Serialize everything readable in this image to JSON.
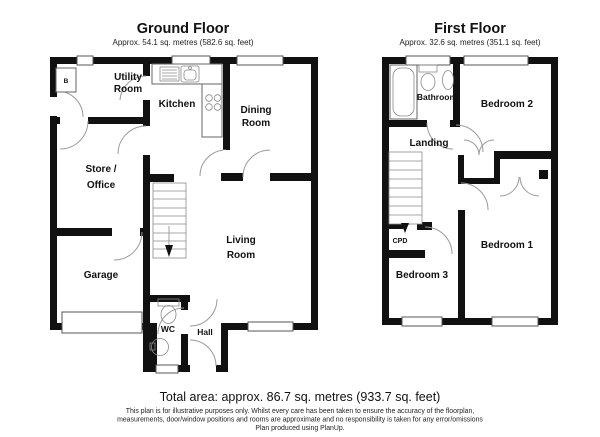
{
  "colors": {
    "wall": "#111111",
    "fixture": "#666666",
    "door_arc": "#9a9a9a"
  },
  "ground_floor": {
    "title": "Ground Floor",
    "area": "Approx. 54.1 sq. metres (582.6 sq. feet)",
    "rooms": {
      "utility": [
        "Utility",
        "Room"
      ],
      "kitchen": [
        "Kitchen"
      ],
      "dining": [
        "Dining",
        "Room"
      ],
      "store": [
        "Store /",
        "Office"
      ],
      "garage": [
        "Garage"
      ],
      "living": [
        "Living",
        "Room"
      ],
      "wc": [
        "WC"
      ],
      "hall": [
        "Hall"
      ],
      "boiler": "B"
    }
  },
  "first_floor": {
    "title": "First Floor",
    "area": "Approx. 32.6 sq. metres (351.1 sq. feet)",
    "rooms": {
      "bathroom": [
        "Bathroom"
      ],
      "bedroom2": [
        "Bedroom 2"
      ],
      "landing": [
        "Landing"
      ],
      "cpd": [
        "CPD"
      ],
      "bedroom3": [
        "Bedroom 3"
      ],
      "bedroom1": [
        "Bedroom 1"
      ]
    }
  },
  "footer": {
    "total_area": "Total area: approx. 86.7 sq. metres (933.7 sq. feet)",
    "disclaimer": [
      "This plan is for illustrative purposes only. Whilst every care has been taken to ensure the accuracy of the floorplan,",
      "measurements, door/window positions and rooms are approximate and no responsibility is taken for any error/omissions",
      "Plan produced using PlanUp."
    ]
  }
}
